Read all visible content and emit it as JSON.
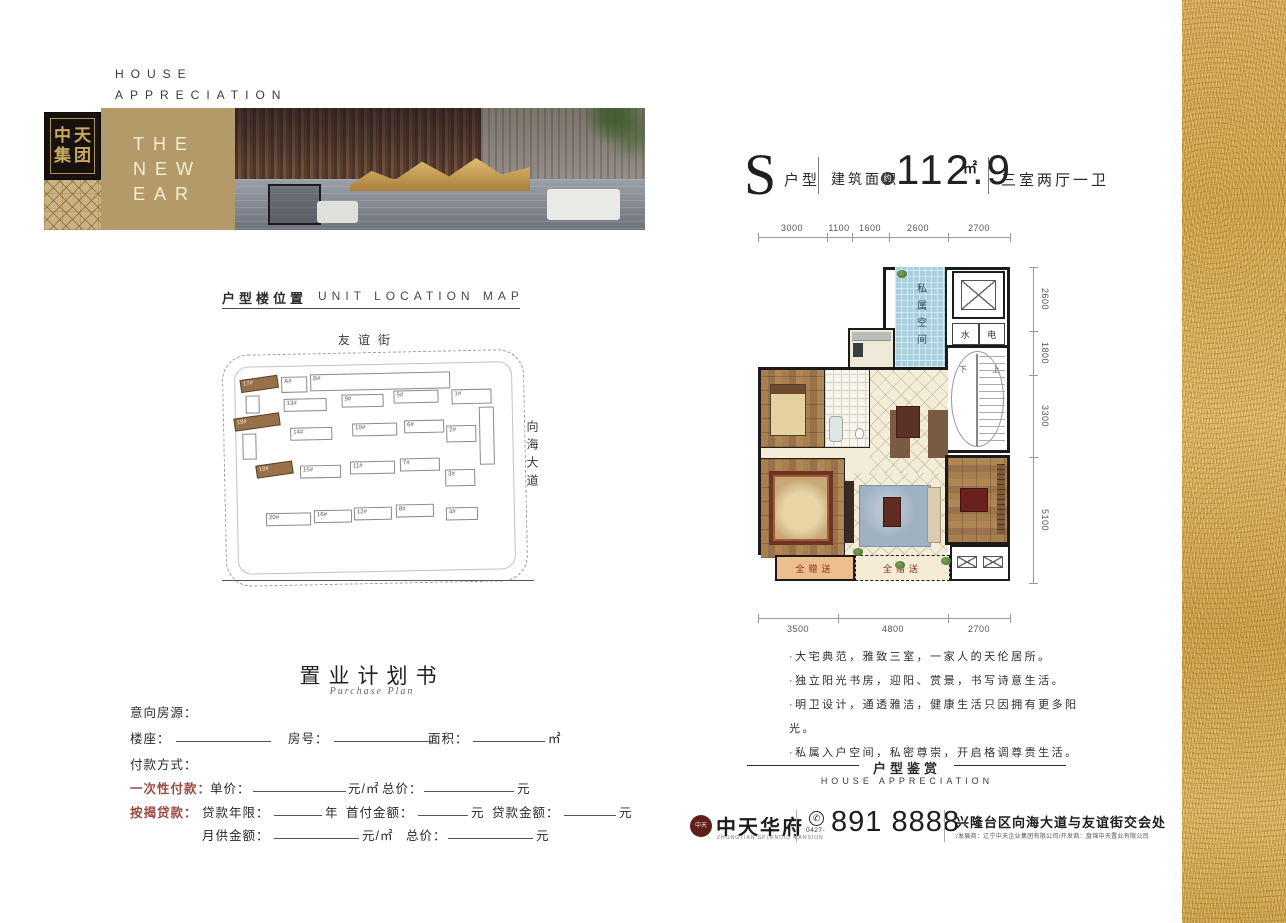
{
  "header": {
    "tagline_line1": "HOUSE",
    "tagline_line2": "APPRECIATION",
    "logo_line1": "中天",
    "logo_line2": "集团",
    "banner_line1": "THE",
    "banner_line2": "NEW",
    "banner_line3": "EAR"
  },
  "unit_title": {
    "letter": "S",
    "type_label": "户型",
    "area_prefix": "建筑面积",
    "area_approx": "约",
    "area_value": "112.9",
    "area_unit": "㎡",
    "rooms": "三室两厅一卫"
  },
  "location_map": {
    "title_cn": "户型楼位置",
    "title_en": "UNIT LOCATION MAP",
    "street_top": "友谊街",
    "street_right": "向海大道",
    "buildings": [
      "17#",
      "A#",
      "B#",
      "1#",
      "13#",
      "9#",
      "5#",
      "18#",
      "14#",
      "10#",
      "6#",
      "2#",
      "19#",
      "15#",
      "11#",
      "7#",
      "3#",
      "20#",
      "16#",
      "12#",
      "8#",
      "4#"
    ]
  },
  "floor_plan": {
    "dims_top": [
      "3000",
      "1100",
      "1600",
      "2600",
      "2700"
    ],
    "dims_right": [
      "2600",
      "1800",
      "3300",
      "5100"
    ],
    "dims_bottom": [
      "3500",
      "4800",
      "2700"
    ],
    "private_space": "私属空间",
    "water": "水",
    "electric": "电",
    "stair_down": "下",
    "stair_up": "上",
    "gift_left": "全赠送",
    "gift_mid": "全赠送"
  },
  "features": [
    "·大宅典范，雅致三室，一家人的天伦居所。",
    "·独立阳光书房，迎阳、赏景，书写诗意生活。",
    "·明卫设计，通透雅洁，健康生活只因拥有更多阳光。",
    "·私属入户空间，私密尊崇，开启格调尊贵生活。"
  ],
  "appreciation": {
    "cn": "户型鉴赏",
    "en": "HOUSE APPRECIATION"
  },
  "purchase_plan": {
    "title": "置业计划书",
    "subtitle": "Purchase Plan",
    "intent_label": "意向房源：",
    "building_label": "楼座：",
    "room_label": "房号：",
    "area_label": "面积：",
    "area_unit": "㎡",
    "payment_label": "付款方式：",
    "onetime_label": "一次性付款：",
    "unit_price_label": "单价：",
    "unit_price_unit": "元/㎡",
    "total_label": "总价：",
    "total_unit": "元",
    "mortgage_label": "按揭贷款：",
    "loan_years_label": "贷款年限：",
    "years_unit": "年",
    "down_label": "首付金额：",
    "down_unit": "元",
    "loan_label": "贷款金额：",
    "loan_unit": "元",
    "monthly_label": "月供金额：",
    "monthly_unit": "元/㎡",
    "total2_label": "总价：",
    "total2_unit": "元"
  },
  "footer": {
    "brand_cn": "中天华府",
    "brand_en": "ZHONGTIAN SPLENDID MANSION",
    "seal_text": "中天",
    "phone_icon": "✆",
    "phone_area": "0427-",
    "phone": "891 8888",
    "address": "兴隆台区向海大道与友谊街交会处",
    "companies": "/发展商：辽宁中天企业集团有限公司/开发商：盘锦中天置业有限公司"
  },
  "colors": {
    "accent_gold": "#b49a68",
    "art_gold": "#d3a94f",
    "form_red": "#9c4a42",
    "plan_blue": "#a9cede",
    "highlight_brown": "#96714a"
  }
}
